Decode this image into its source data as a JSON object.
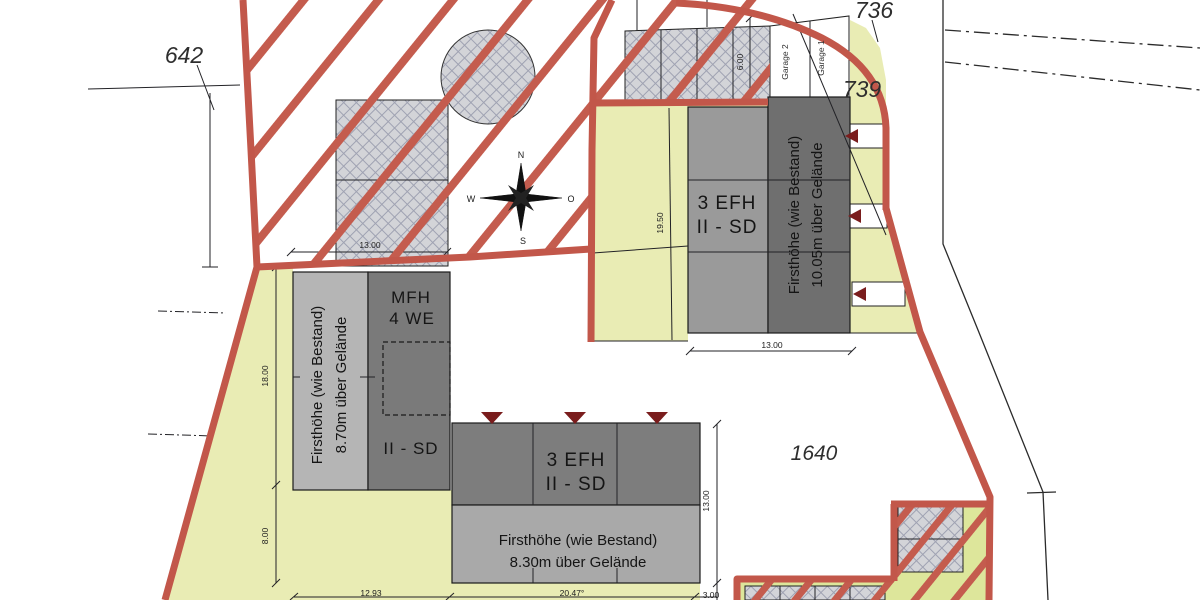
{
  "labels": {
    "parcel_642": "642",
    "parcel_736": "736",
    "parcel_739": "739",
    "parcel_1640": "1640",
    "garage_1": "Garage 1",
    "garage_2": "Garage 2"
  },
  "buildings": {
    "mfh": {
      "name_line1": "MFH",
      "name_line2": "4 WE",
      "storeys": "II - SD",
      "ridge_line1": "Firsthöhe (wie Bestand)",
      "ridge_line2": "8.70m über Gelände"
    },
    "efh_south": {
      "name_line1": "3 EFH",
      "name_line2": "II - SD",
      "ridge_line1": "Firsthöhe (wie Bestand)",
      "ridge_line2": "8.30m über Gelände"
    },
    "efh_east": {
      "name_line1": "3 EFH",
      "name_line2": "II - SD",
      "ridge_line1": "Firsthöhe (wie Bestand)",
      "ridge_line2": "10.05m über Gelände"
    }
  },
  "dimensions": {
    "nw_width": "13.00",
    "garage_depth": "6.00",
    "east_depth": "19.50",
    "east_width": "13.00",
    "west_depth": "18.00",
    "west_gap": "8.00",
    "south_left": "12.93",
    "south_width": "20.47°",
    "south_depth": "13.00",
    "south_gap": "3.00"
  },
  "compass": {
    "north": "N",
    "east": "O",
    "south": "S",
    "west": "W"
  },
  "colors": {
    "boundary_red": "#c2574a",
    "plot_yellow": "#e9ecb4",
    "plot_yellow_se": "#dde69b",
    "arrow_dark_red": "#7a1d1d",
    "hatch_gray": "#d3d4d8"
  }
}
